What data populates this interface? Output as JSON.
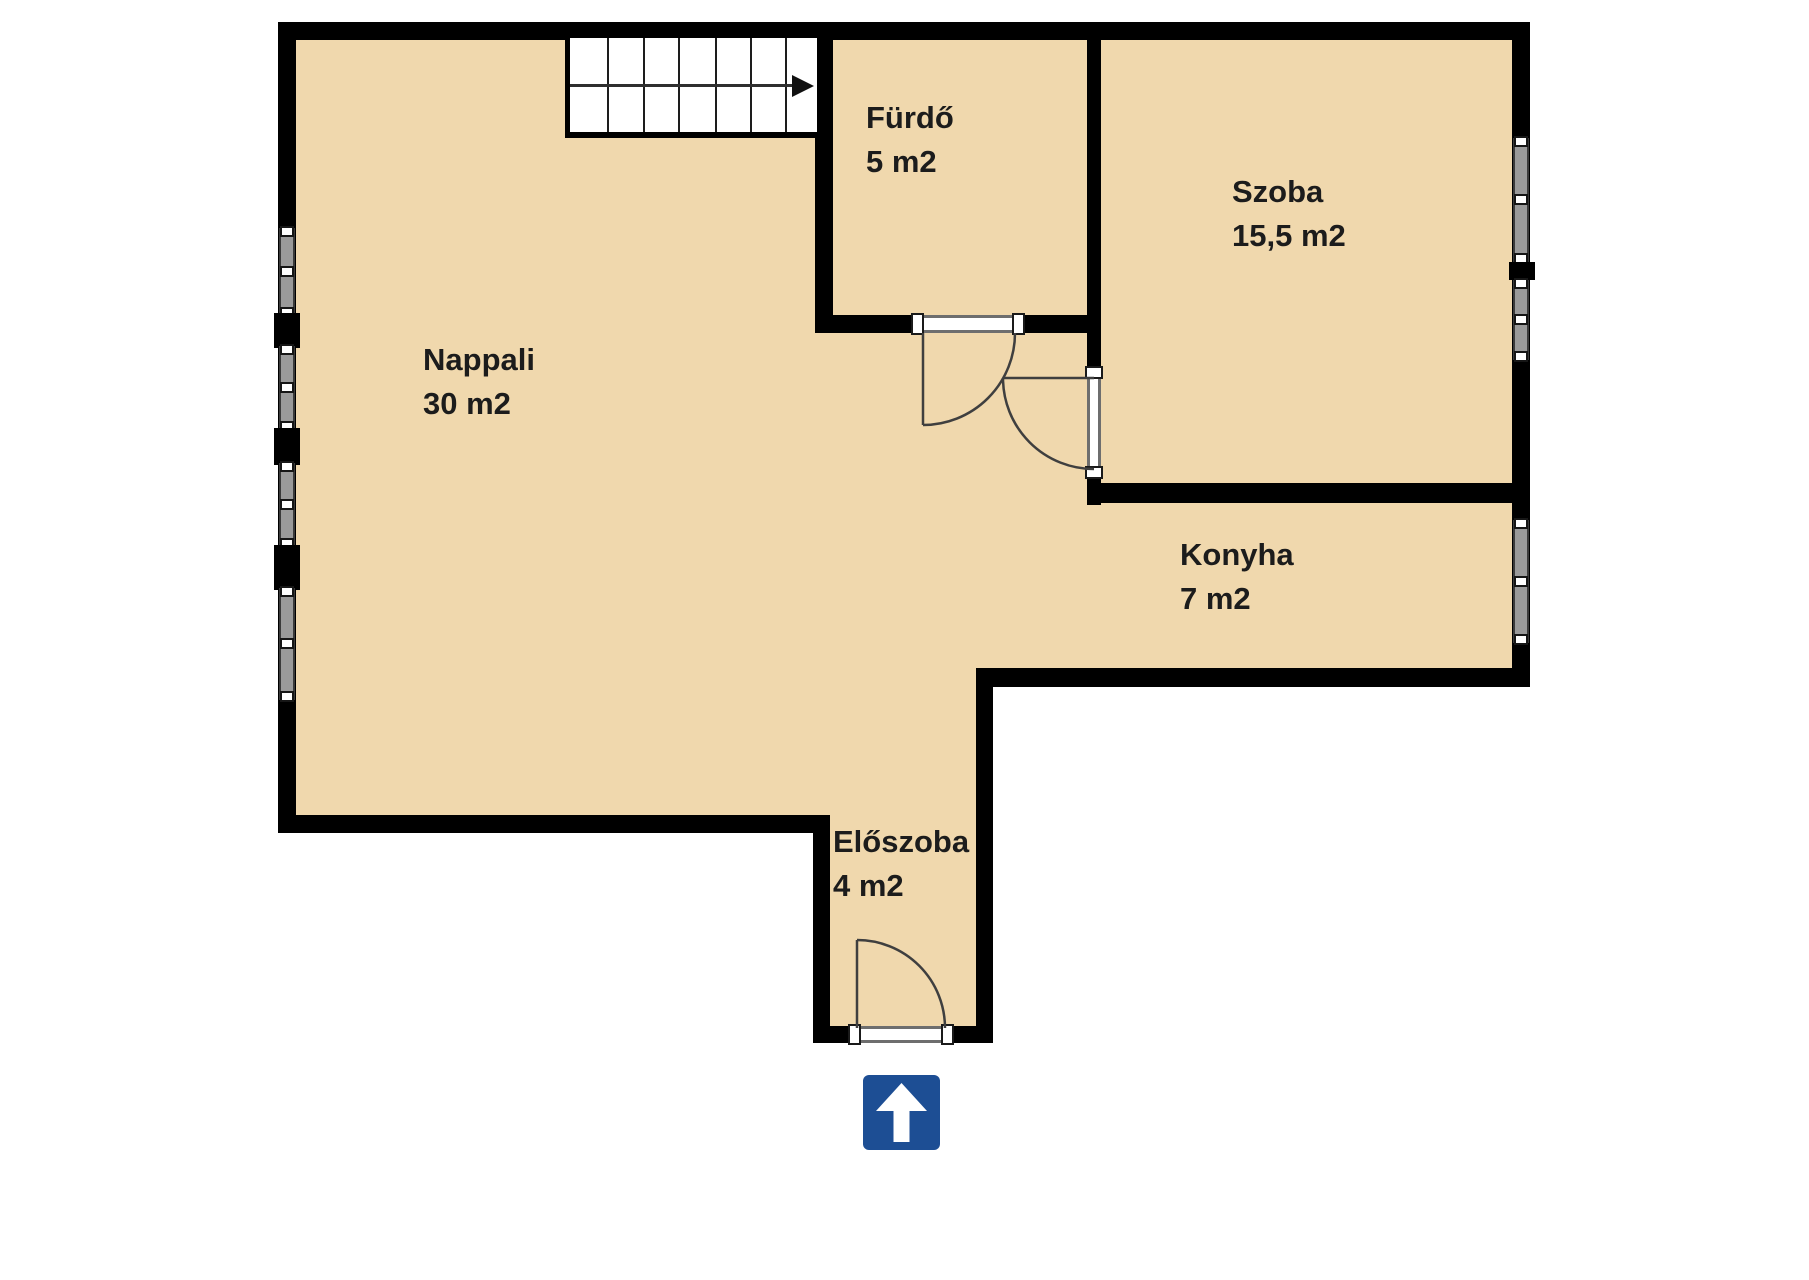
{
  "title": "Apartment floor plan",
  "palette": {
    "background": "#ffffff",
    "floor": "#f0d8ad",
    "wall": "#000000",
    "window_glass": "#9a9a9a",
    "window_frame": "#3a3a3a",
    "door_line": "#3f3f3f",
    "entrance_sign_blue": "#1d4e94",
    "text": "#1c1c1c"
  },
  "rooms": [
    {
      "id": "nappali",
      "name": "Nappali",
      "area": "30 m2"
    },
    {
      "id": "furdo",
      "name": "Fürdő",
      "area": "5 m2"
    },
    {
      "id": "szoba",
      "name": "Szoba",
      "area": "15,5 m2"
    },
    {
      "id": "konyha",
      "name": "Konyha",
      "area": "7 m2"
    },
    {
      "id": "eloszoba",
      "name": "Előszoba",
      "area": "4 m2"
    }
  ],
  "icons": {
    "entrance_arrow": "up-arrow-sign",
    "stairs_direction": "right-arrow"
  }
}
